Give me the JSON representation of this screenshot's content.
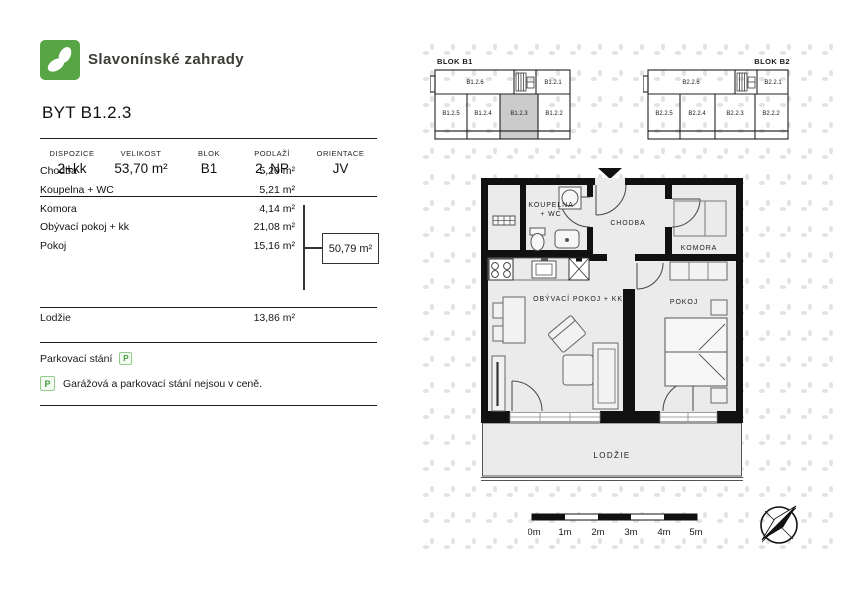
{
  "brand": {
    "name": "Slavonínské zahrady",
    "logo_icon": "leaf-pair-icon"
  },
  "title": "BYT B1.2.3",
  "summary": {
    "columns": [
      {
        "header": "DISPOZICE",
        "value": "2+kk"
      },
      {
        "header": "VELIKOST",
        "value": "53,70 m²"
      },
      {
        "header": "BLOK",
        "value": "B1"
      },
      {
        "header": "PODLAŽÍ",
        "value": "2. NP"
      },
      {
        "header": "ORIENTACE",
        "value": "JV"
      }
    ]
  },
  "rooms": [
    {
      "label": "Chodba",
      "area": "5,20 m²"
    },
    {
      "label": "Koupelna + WC",
      "area": "5,21 m²"
    },
    {
      "label": "Komora",
      "area": "4,14 m²"
    },
    {
      "label": "Obývací pokoj + kk",
      "area": "21,08 m²"
    },
    {
      "label": "Pokoj",
      "area": "15,16 m²"
    }
  ],
  "interior_total": "50,79 m²",
  "balcony": {
    "label": "Lodžie",
    "area": "13,86 m²"
  },
  "parking": {
    "label": "Parkovací stání",
    "badge": "P",
    "note": "Garážová a parkovací stání nejsou v ceně."
  },
  "blocks": {
    "b1": {
      "label": "BLOK B1",
      "top_units": [
        "B1.2.6",
        "B1.2.1"
      ],
      "bottom_units": [
        "B1.2.5",
        "B1.2.4",
        "B1.2.3",
        "B1.2.2"
      ],
      "highlighted_unit": "B1.2.3"
    },
    "b2": {
      "label": "BLOK B2",
      "top_units": [
        "B2.2.6",
        "B2.2.1"
      ],
      "bottom_units": [
        "B2.2.5",
        "B2.2.4",
        "B2.2.3",
        "B2.2.2"
      ]
    }
  },
  "floorplan": {
    "labels": {
      "koupelna_line1": "KOUPELNA",
      "koupelna_line2": "+ WC",
      "chodba": "CHODBA",
      "komora": "KOMORA",
      "obyvaci": "OBÝVACÍ POKOJ + KK",
      "pokoj": "POKOJ",
      "lodzie": "LODŽIE"
    }
  },
  "scalebar": {
    "labels": [
      "0m",
      "1m",
      "2m",
      "3m",
      "4m",
      "5m"
    ]
  },
  "colors": {
    "brand_green": "#58a546",
    "unit_highlight": "#cccccc"
  }
}
